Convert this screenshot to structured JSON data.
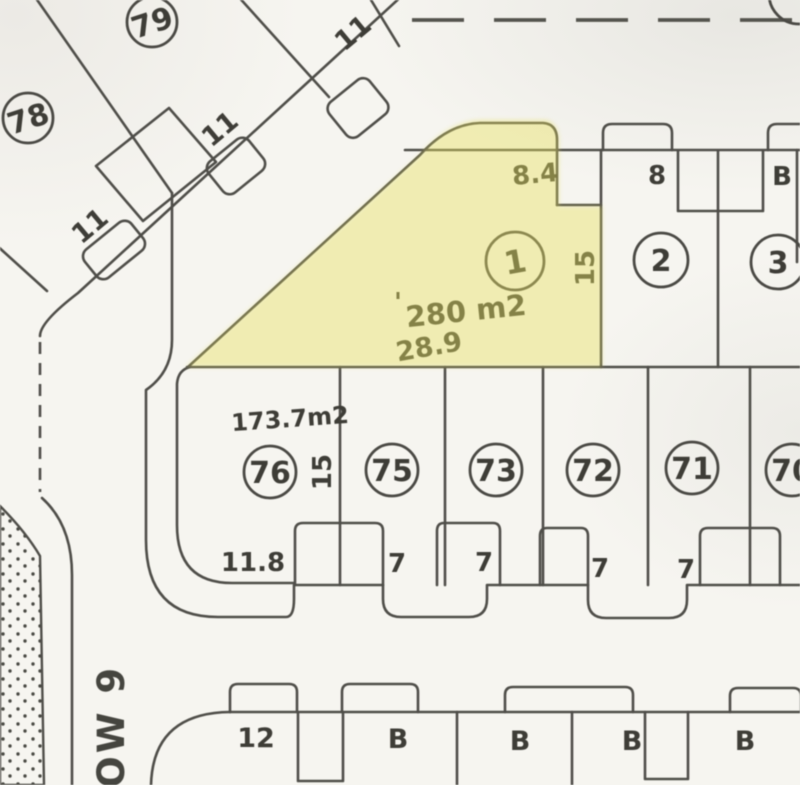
{
  "colors": {
    "background": "#f6f5f0",
    "line": "#4f4e49",
    "highlight_fill": "#e6df5e",
    "text": "#3e3d37"
  },
  "diagonal_block": {
    "lot_numbers": [
      "79",
      "78"
    ],
    "frontage_labels": [
      "11",
      "11",
      "11"
    ]
  },
  "upper_row": {
    "highlight_lot": {
      "number": "1",
      "area": "280 m2",
      "area_tick": "'",
      "dim_top": "8.4",
      "dim_right": "15",
      "dim_bottom": "28.9"
    },
    "lot2": {
      "number": "2",
      "front_label": "8"
    },
    "lot3": {
      "number": "3"
    },
    "right_edge_label": "B"
  },
  "middle_row": {
    "area_label": "173.7m2",
    "lot76_side_label": "15",
    "lot_numbers": [
      "76",
      "75",
      "73",
      "72",
      "71",
      "70"
    ],
    "front_labels": [
      "11.8",
      "7",
      "7",
      "7",
      "7"
    ]
  },
  "bottom_row": {
    "lot_labels": [
      "12",
      "B",
      "B",
      "B",
      "B"
    ]
  },
  "road_label": "ROW 9"
}
